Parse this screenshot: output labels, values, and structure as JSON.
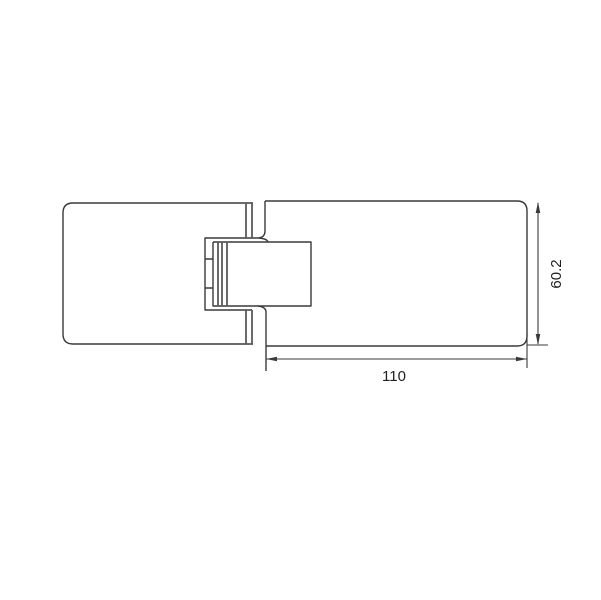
{
  "colors": {
    "line": "#3a3a3a",
    "detail-line": "#5a5a5a",
    "text": "#1d1d1d",
    "background": "#ffffff"
  },
  "drawing": {
    "type": "technical-drawing",
    "subject": "glass-door-hinge-top-view",
    "dimensions": {
      "horizontal": {
        "label": "110"
      },
      "vertical": {
        "label": "60.2"
      }
    }
  }
}
